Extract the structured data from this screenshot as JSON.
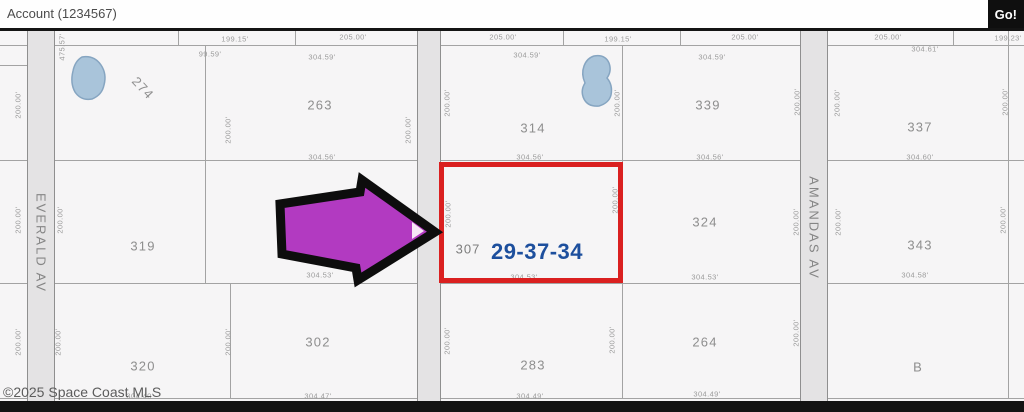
{
  "colors": {
    "map-bg": "#f6f5f6",
    "parcel-line": "#a3a3a3",
    "road-fill": "#e4e3e4",
    "road-line": "#8f8f8f",
    "dim-text": "#9b9b9b",
    "label-text": "#8e8e8e",
    "accent-red": "#da2020",
    "arrow-fill": "#b23ac1",
    "arrow-outline": "#0d0d0d",
    "selected-blue": "#1d4f9d",
    "pond-fill": "#a9c4da",
    "pond-line": "#86a5c1",
    "bar-black": "#131313"
  },
  "header": {
    "account_label": "Account (1234567)",
    "go_button": "Go!"
  },
  "map": {
    "copyright": "©2025 Space Coast MLS",
    "selected_parcel": {
      "number": "307",
      "section": "29-37-34"
    },
    "roads": [
      {
        "name": "EVERALD AV",
        "x": 27,
        "w": 28,
        "label_y": 243
      },
      {
        "name": "",
        "x": 417,
        "w": 24,
        "label_y": 0
      },
      {
        "name": "AMANDAS AV",
        "x": 800,
        "w": 28,
        "label_y": 228
      }
    ],
    "parcel_labels": [
      {
        "text": "274",
        "x": 143,
        "y": 88,
        "rotate": 47
      },
      {
        "text": "263",
        "x": 320,
        "y": 105
      },
      {
        "text": "314",
        "x": 533,
        "y": 128
      },
      {
        "text": "339",
        "x": 708,
        "y": 105
      },
      {
        "text": "337",
        "x": 920,
        "y": 127
      },
      {
        "text": "319",
        "x": 143,
        "y": 246
      },
      {
        "text": "324",
        "x": 705,
        "y": 222
      },
      {
        "text": "343",
        "x": 920,
        "y": 245
      },
      {
        "text": "320",
        "x": 143,
        "y": 366
      },
      {
        "text": "302",
        "x": 318,
        "y": 342
      },
      {
        "text": "283",
        "x": 533,
        "y": 365
      },
      {
        "text": "264",
        "x": 705,
        "y": 342
      },
      {
        "text": "B",
        "x": 918,
        "y": 367
      }
    ],
    "dimension_labels": [
      {
        "text": "199.15'",
        "x": 235,
        "y": 39
      },
      {
        "text": "205.00'",
        "x": 353,
        "y": 37
      },
      {
        "text": "205.00'",
        "x": 503,
        "y": 37
      },
      {
        "text": "199.15'",
        "x": 618,
        "y": 39
      },
      {
        "text": "205.00'",
        "x": 745,
        "y": 37
      },
      {
        "text": "205.00'",
        "x": 888,
        "y": 37
      },
      {
        "text": "199.23'",
        "x": 1008,
        "y": 38
      },
      {
        "text": "99.59'",
        "x": 210,
        "y": 54
      },
      {
        "text": "304.59'",
        "x": 322,
        "y": 57
      },
      {
        "text": "304.59'",
        "x": 527,
        "y": 55
      },
      {
        "text": "304.59'",
        "x": 712,
        "y": 57
      },
      {
        "text": "304.61'",
        "x": 925,
        "y": 49
      },
      {
        "text": "304.56'",
        "x": 322,
        "y": 157
      },
      {
        "text": "304.56'",
        "x": 530,
        "y": 157
      },
      {
        "text": "304.56'",
        "x": 710,
        "y": 157
      },
      {
        "text": "304.60'",
        "x": 920,
        "y": 157
      },
      {
        "text": "304.53'",
        "x": 320,
        "y": 275
      },
      {
        "text": "304.53'",
        "x": 524,
        "y": 277
      },
      {
        "text": "304.53'",
        "x": 705,
        "y": 277
      },
      {
        "text": "304.58'",
        "x": 915,
        "y": 275
      },
      {
        "text": "304.40'",
        "x": 140,
        "y": 396
      },
      {
        "text": "304.47'",
        "x": 318,
        "y": 396
      },
      {
        "text": "304.49'",
        "x": 530,
        "y": 396
      },
      {
        "text": "304.49'",
        "x": 707,
        "y": 394
      },
      {
        "text": "200.00'",
        "x": 18,
        "y": 105,
        "v": true
      },
      {
        "text": "475.57'",
        "x": 62,
        "y": 47,
        "v": true
      },
      {
        "text": "200.00'",
        "x": 228,
        "y": 130,
        "v": true
      },
      {
        "text": "200.00'",
        "x": 408,
        "y": 130,
        "v": true
      },
      {
        "text": "200.00'",
        "x": 447,
        "y": 103,
        "v": true
      },
      {
        "text": "200.00'",
        "x": 617,
        "y": 103,
        "v": true
      },
      {
        "text": "200.00'",
        "x": 797,
        "y": 102,
        "v": true
      },
      {
        "text": "200.00'",
        "x": 837,
        "y": 103,
        "v": true
      },
      {
        "text": "200.00'",
        "x": 1005,
        "y": 102,
        "v": true
      },
      {
        "text": "200.00'",
        "x": 18,
        "y": 220,
        "v": true
      },
      {
        "text": "200.00'",
        "x": 60,
        "y": 220,
        "v": true
      },
      {
        "text": "200.00'",
        "x": 448,
        "y": 214,
        "v": true
      },
      {
        "text": "200.00'",
        "x": 615,
        "y": 200,
        "v": true
      },
      {
        "text": "200.00'",
        "x": 796,
        "y": 222,
        "v": true
      },
      {
        "text": "200.00'",
        "x": 838,
        "y": 222,
        "v": true
      },
      {
        "text": "200.00'",
        "x": 1003,
        "y": 220,
        "v": true
      },
      {
        "text": "200.00'",
        "x": 18,
        "y": 342,
        "v": true
      },
      {
        "text": "200.00'",
        "x": 58,
        "y": 342,
        "v": true
      },
      {
        "text": "200.00'",
        "x": 228,
        "y": 342,
        "v": true
      },
      {
        "text": "200.00'",
        "x": 447,
        "y": 341,
        "v": true
      },
      {
        "text": "200.00'",
        "x": 612,
        "y": 340,
        "v": true
      },
      {
        "text": "200.00'",
        "x": 796,
        "y": 333,
        "v": true
      }
    ],
    "lines_h": [
      {
        "y": 45,
        "x1": 0,
        "x2": 1024
      },
      {
        "y": 65,
        "x1": 0,
        "x2": 28
      },
      {
        "y": 160,
        "x1": 0,
        "x2": 1024
      },
      {
        "y": 283,
        "x1": 0,
        "x2": 1024
      },
      {
        "y": 398,
        "x1": 0,
        "x2": 1024
      }
    ],
    "lines_v": [
      {
        "x": 178,
        "y1": 31,
        "y2": 45
      },
      {
        "x": 295,
        "y1": 31,
        "y2": 45
      },
      {
        "x": 563,
        "y1": 31,
        "y2": 45
      },
      {
        "x": 680,
        "y1": 31,
        "y2": 45
      },
      {
        "x": 953,
        "y1": 31,
        "y2": 45
      },
      {
        "x": 205,
        "y1": 45,
        "y2": 283
      },
      {
        "x": 230,
        "y1": 283,
        "y2": 398
      },
      {
        "x": 622,
        "y1": 45,
        "y2": 398
      },
      {
        "x": 1008,
        "y1": 31,
        "y2": 398
      }
    ]
  }
}
